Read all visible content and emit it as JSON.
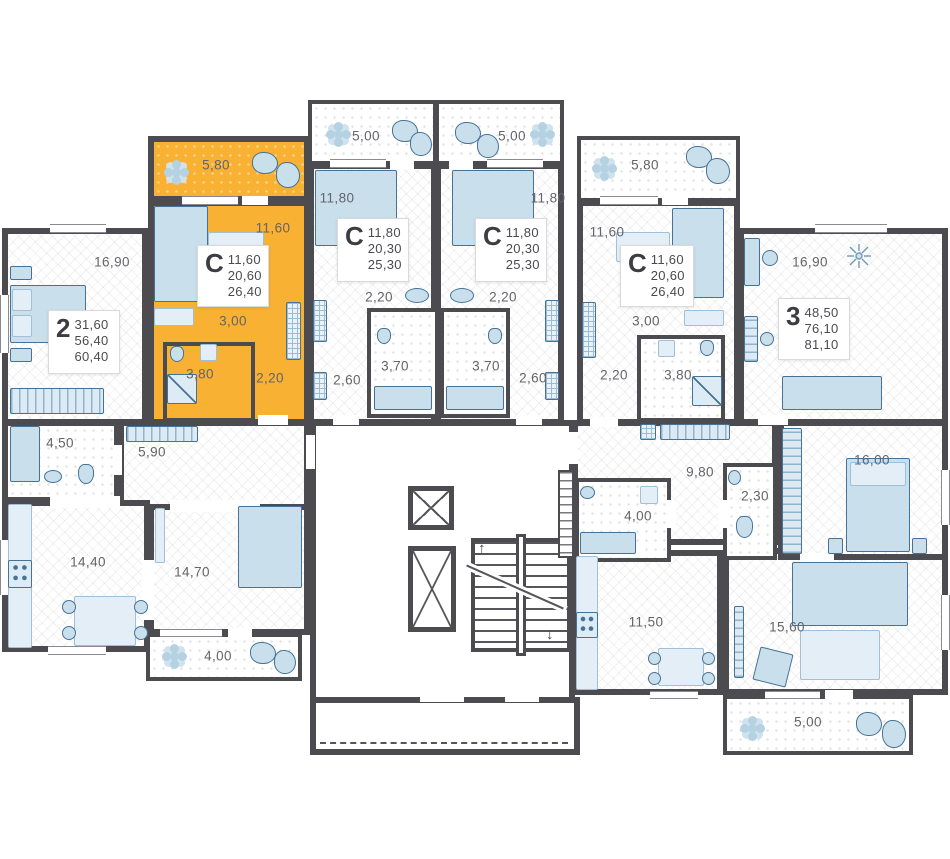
{
  "colors": {
    "highlight": "#F8B133",
    "wall": "#4C4C50",
    "furniture_fill": "#C9DFEC",
    "furniture_stroke": "#477297",
    "label_text": "#64646B",
    "card_text": "#4A4A52"
  },
  "apartments": [
    {
      "name": "2-room apartment",
      "type": "2",
      "areas": [
        "31,60",
        "56,40",
        "60,40"
      ],
      "highlighted": false,
      "rooms": [
        {
          "label": "16,90"
        },
        {
          "label": "4,50"
        },
        {
          "label": "5,90"
        },
        {
          "label": "14,40"
        },
        {
          "label": "14,70"
        },
        {
          "label": "4,00"
        }
      ]
    },
    {
      "name": "studio apartment highlighted",
      "type": "C",
      "areas": [
        "11,60",
        "20,60",
        "26,40"
      ],
      "highlighted": true,
      "rooms": [
        {
          "label": "5,80"
        },
        {
          "label": "11,60"
        },
        {
          "label": "3,00"
        },
        {
          "label": "3,80"
        },
        {
          "label": "2,20"
        }
      ]
    },
    {
      "name": "studio apartment middle-left",
      "type": "C",
      "areas": [
        "11,80",
        "20,30",
        "25,30"
      ],
      "highlighted": false,
      "rooms": [
        {
          "label": "5,00"
        },
        {
          "label": "11,80"
        },
        {
          "label": "2,20"
        },
        {
          "label": "3,70"
        },
        {
          "label": "2,60"
        }
      ]
    },
    {
      "name": "studio apartment middle-right",
      "type": "C",
      "areas": [
        "11,80",
        "20,30",
        "25,30"
      ],
      "highlighted": false,
      "rooms": [
        {
          "label": "5,00"
        },
        {
          "label": "11,80"
        },
        {
          "label": "2,20"
        },
        {
          "label": "3,70"
        },
        {
          "label": "2,60"
        }
      ]
    },
    {
      "name": "studio apartment right",
      "type": "C",
      "areas": [
        "11,60",
        "20,60",
        "26,40"
      ],
      "highlighted": false,
      "rooms": [
        {
          "label": "5,80"
        },
        {
          "label": "11,60"
        },
        {
          "label": "3,00"
        },
        {
          "label": "3,80"
        },
        {
          "label": "2,20"
        }
      ]
    },
    {
      "name": "3-room apartment",
      "type": "3",
      "areas": [
        "48,50",
        "76,10",
        "81,10"
      ],
      "highlighted": false,
      "rooms": [
        {
          "label": "16,90"
        },
        {
          "label": "9,80"
        },
        {
          "label": "4,00"
        },
        {
          "label": "2,30"
        },
        {
          "label": "16,00"
        },
        {
          "label": "11,50"
        },
        {
          "label": "15,60"
        },
        {
          "label": "5,00"
        }
      ]
    }
  ],
  "icons": {
    "stairs_up": "↑",
    "stairs_down": "↓"
  }
}
